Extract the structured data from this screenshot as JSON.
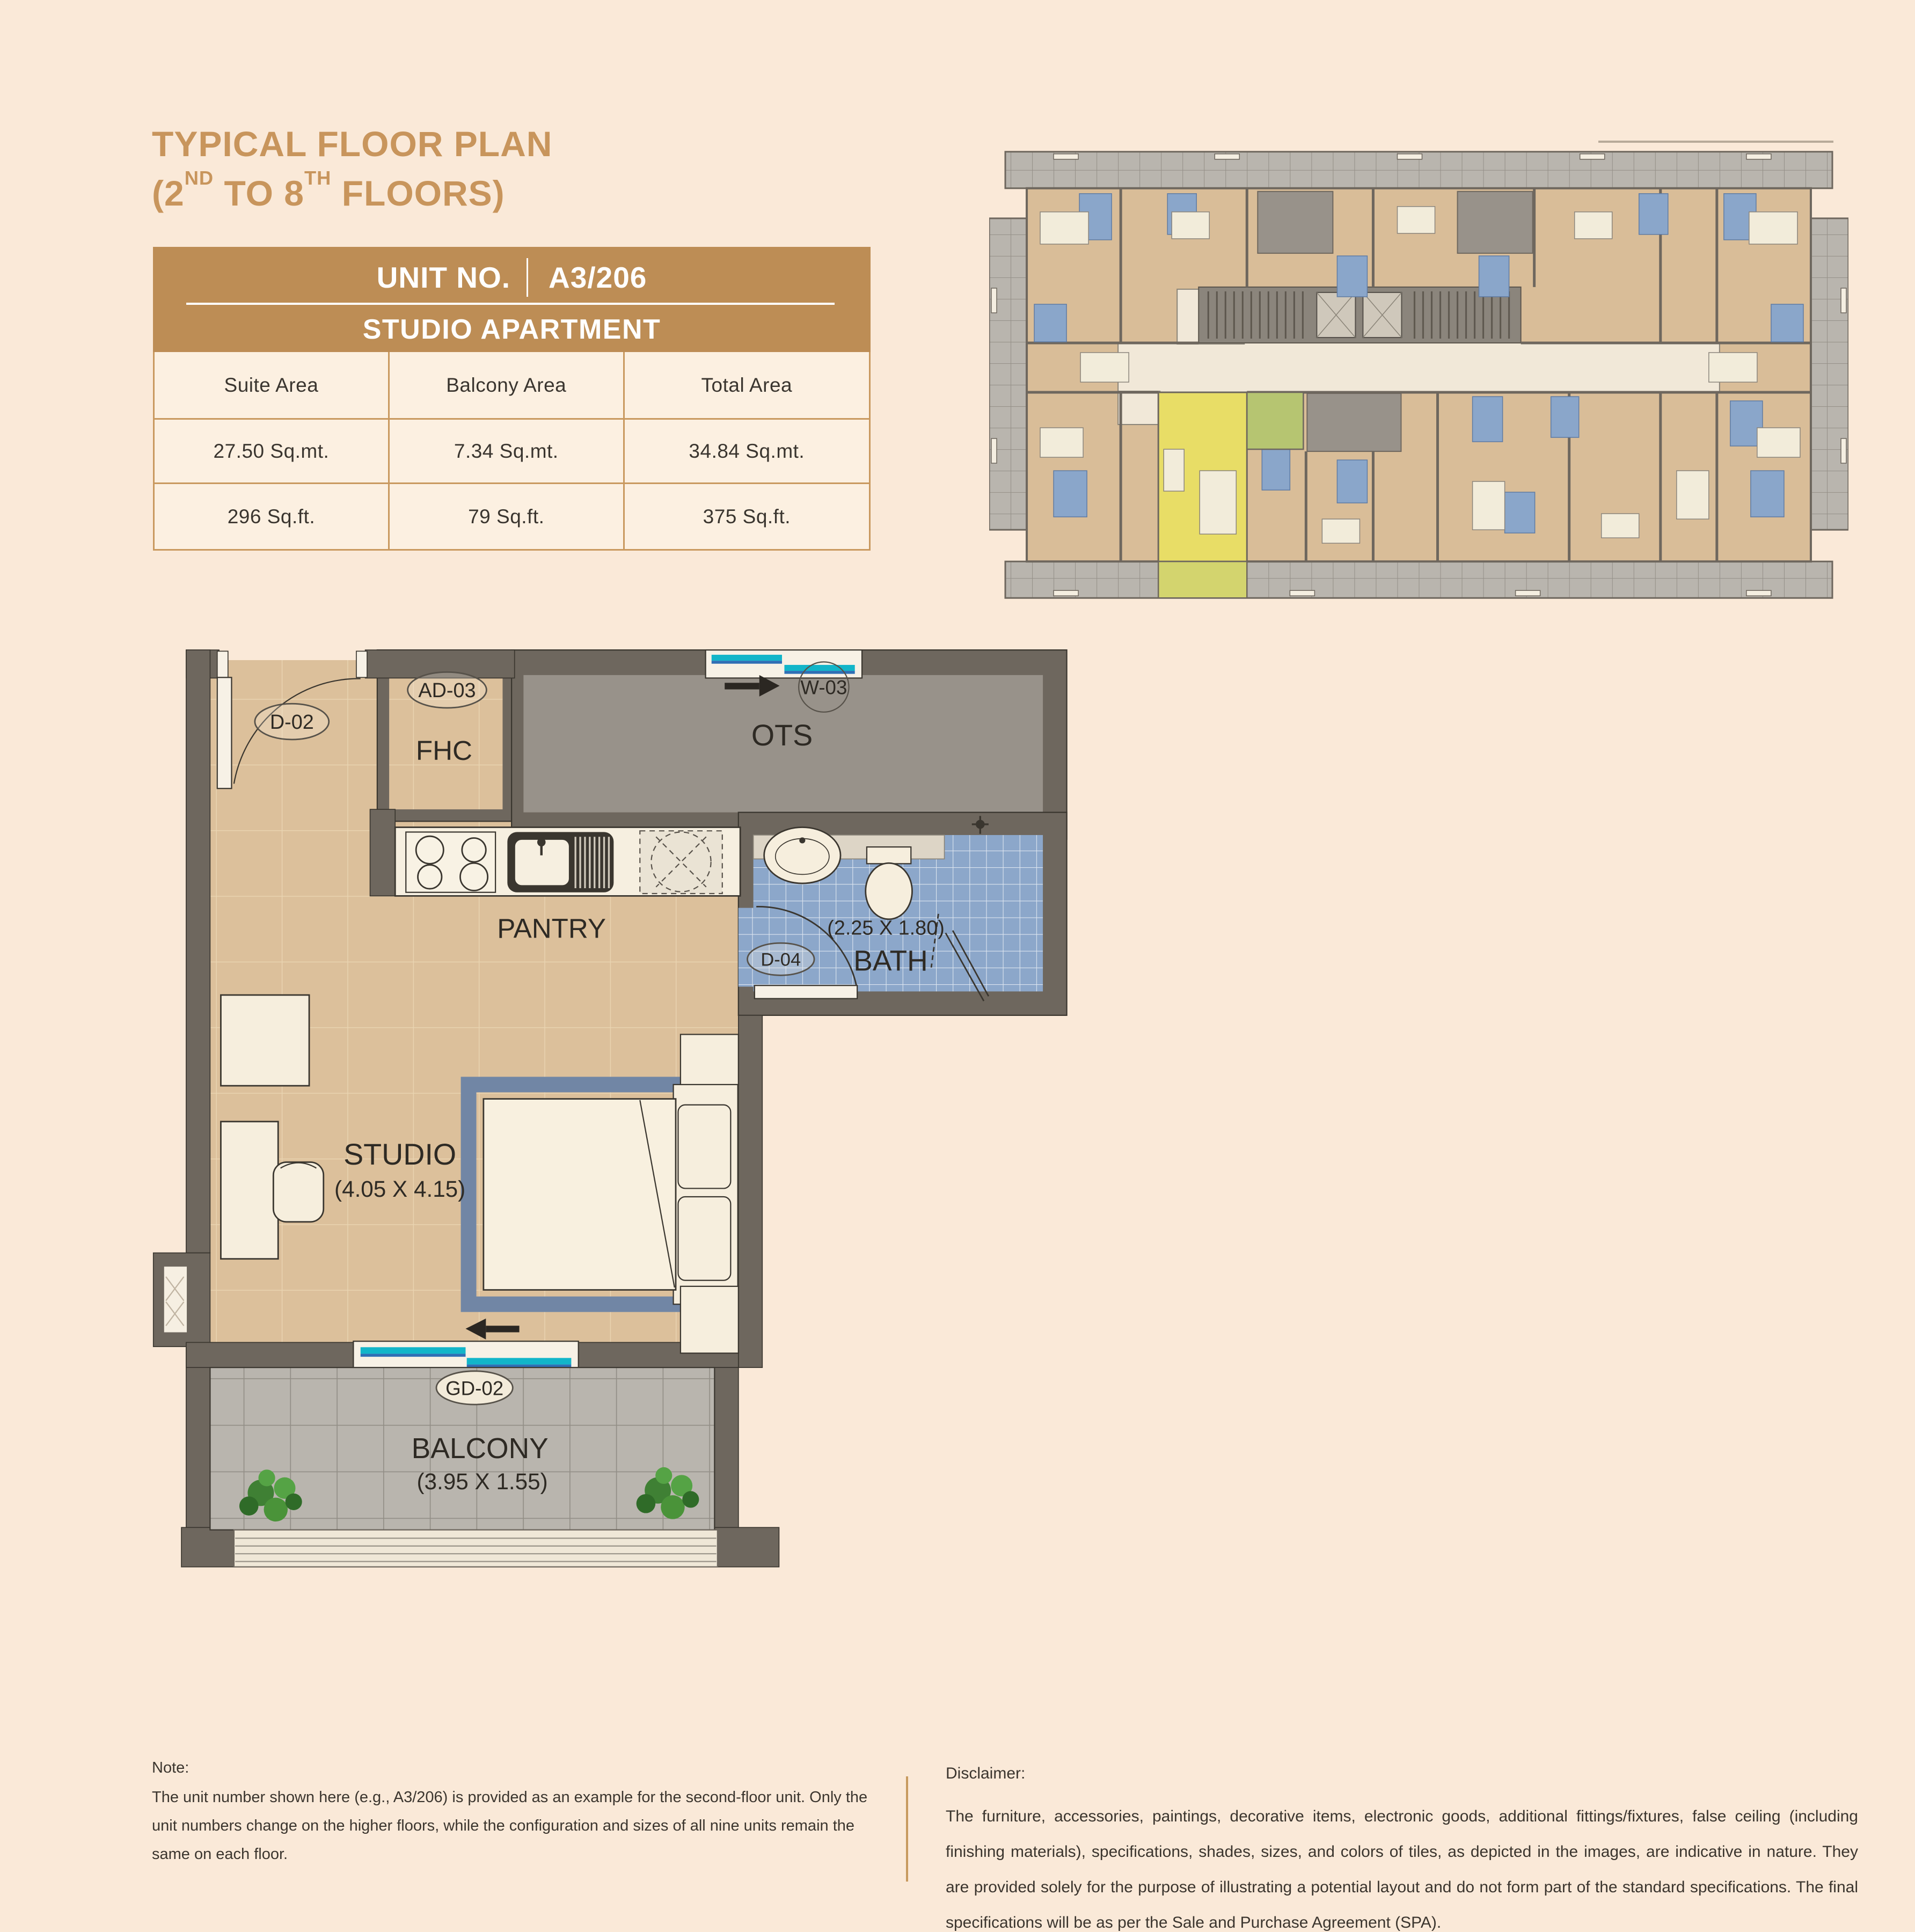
{
  "title": {
    "line1": "TYPICAL FLOOR PLAN",
    "line2_pre": "(2",
    "line2_sup1": "ND",
    "line2_mid": " TO 8",
    "line2_sup2": "TH",
    "line2_post": " FLOORS)"
  },
  "unit_table": {
    "header": {
      "unit_no_label": "UNIT NO.",
      "unit_no_value": "A3/206",
      "subtitle": "STUDIO APARTMENT"
    },
    "columns": [
      "Suite Area",
      "Balcony Area",
      "Total Area"
    ],
    "rows": [
      [
        "27.50 Sq.mt.",
        "7.34 Sq.mt.",
        "34.84 Sq.mt."
      ],
      [
        "296 Sq.ft.",
        "79 Sq.ft.",
        "375 Sq.ft."
      ]
    ]
  },
  "floor_plan": {
    "labels": {
      "entry_door": "D-02",
      "ac_duct": "AD-03",
      "fhc": "FHC",
      "window_top": "W-03",
      "ots": "OTS",
      "pantry": "PANTRY",
      "bath_door": "D-04",
      "bath_dim": "(2.25 X 1.80)",
      "bath": "BATH",
      "studio": "STUDIO",
      "studio_dim": "(4.05 X 4.15)",
      "balcony_door": "GD-02",
      "balcony": "BALCONY",
      "balcony_dim": "(3.95 X 1.55)"
    }
  },
  "note": {
    "heading": "Note:",
    "body": "The unit number shown here (e.g., A3/206) is provided as an example for the second-floor unit. Only the unit numbers change on the higher floors, while the configuration and sizes of all nine units remain the same on each floor."
  },
  "disclaimer": {
    "heading": "Disclaimer:",
    "body": "The furniture, accessories, paintings, decorative items, electronic goods, additional fittings/fixtures, false ceiling (including finishing materials), specifications, shades, sizes, and colors of tiles, as depicted in the images, are indicative in nature. They are provided solely for the purpose of illustrating a potential layout and do not form part of the standard specifications. The final specifications will be as per the Sale and Purchase Agreement (SPA)."
  },
  "colors": {
    "page_bg": "#fae9d8",
    "title_gold": "#c8955c",
    "table_header_bg": "#bd8d55",
    "table_border": "#c9995f",
    "table_cell_bg": "#fcf0e1",
    "wall": "#6e675e",
    "floor_tan": "#dcc09b",
    "ots_gray": "#98928a",
    "bath_blue": "#8ca7ca",
    "balcony_gray": "#b9b5ae",
    "window_teal": "#12b5c9",
    "window_blue": "#2f6fb5",
    "highlight_unit_yellow": "#e8dd66",
    "highlight_bath_green": "#b6c571",
    "highlight_balcony": "#d3d46e",
    "plant_green": "#4a9339"
  }
}
